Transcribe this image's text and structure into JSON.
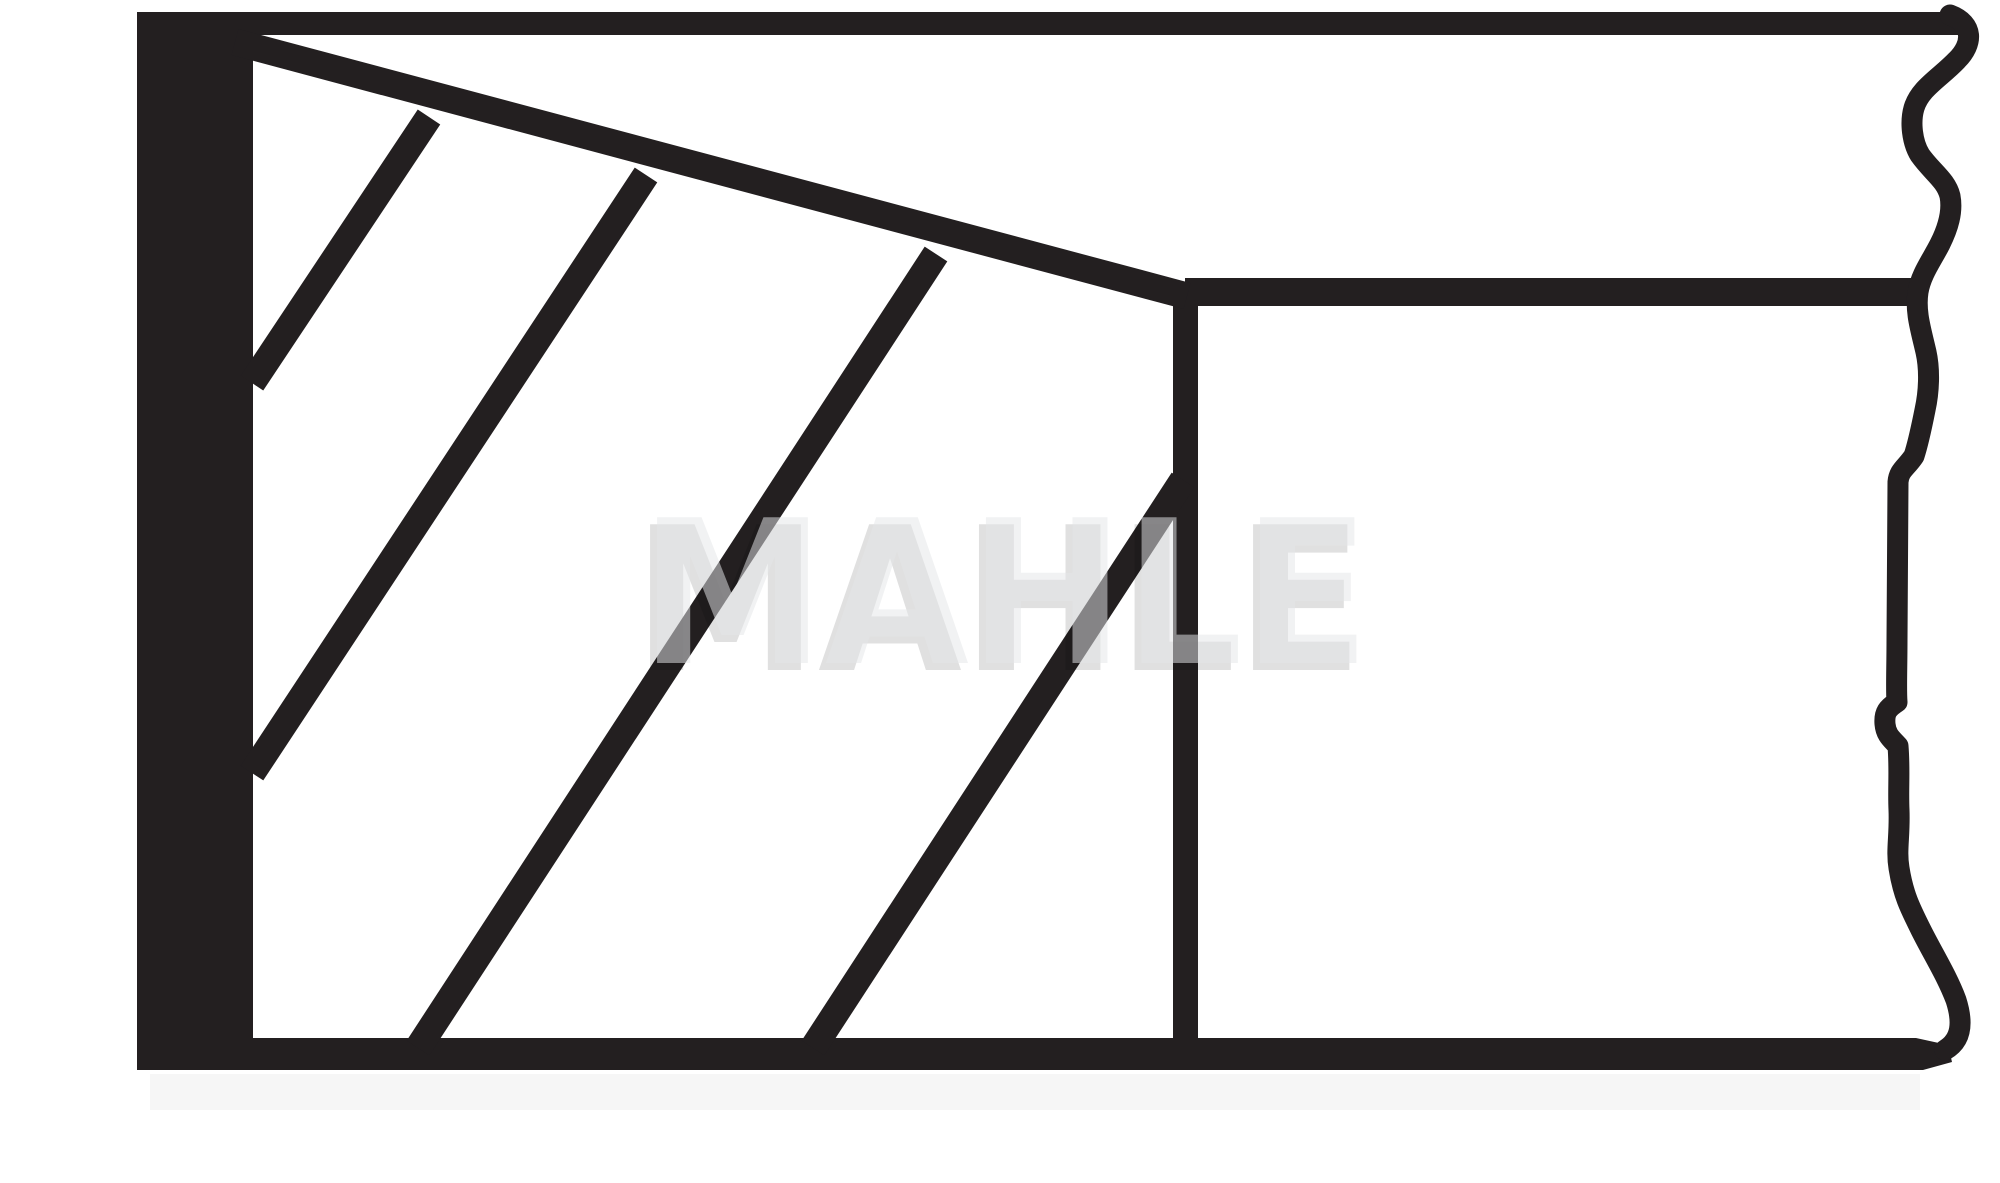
{
  "drawing": {
    "description": "Black-and-white technical line drawing: cross-section of a tapered piston ring (hatched section at left, broken-out side view at right)",
    "ink_color": "#231f20",
    "background_color": "#ffffff",
    "watermark": {
      "text": "MAHLE",
      "face_color": "rgba(228,230,232,0.52)",
      "shadow_color": "rgba(0,0,0,0.12)"
    },
    "shapes": {
      "underlay": {
        "name": "scan-shadow-strip",
        "x": 150,
        "y": 1074,
        "w": 1770,
        "h": 36,
        "fill": "#f6f6f6"
      },
      "rects": [
        {
          "name": "top-flank-line",
          "x": 137,
          "y": 12,
          "w": 1821,
          "h": 23
        },
        {
          "name": "left-face-bar",
          "x": 137,
          "y": 12,
          "w": 116,
          "h": 1058
        },
        {
          "name": "groove-top-line",
          "x": 1185,
          "y": 278,
          "w": 733,
          "h": 28
        },
        {
          "name": "ring-divider-line",
          "x": 1173,
          "y": 283,
          "w": 25,
          "h": 759
        }
      ],
      "polygons": [
        {
          "name": "bottom-flank-line",
          "points": "137,1038 1916,1038 1948,1045 1952,1062 1923,1070 137,1070"
        }
      ],
      "lines": [
        {
          "name": "taper-face-line",
          "x1": 235,
          "y1": 42,
          "x2": 1187,
          "y2": 296,
          "w": 27
        },
        {
          "name": "hatch-line-1",
          "x1": 252,
          "y1": 383,
          "x2": 429,
          "y2": 117,
          "w": 27
        },
        {
          "name": "hatch-line-2",
          "x1": 252,
          "y1": 773,
          "x2": 646,
          "y2": 175,
          "w": 27
        },
        {
          "name": "hatch-line-3",
          "x1": 418,
          "y1": 1048,
          "x2": 936,
          "y2": 254,
          "w": 27
        },
        {
          "name": "hatch-line-4",
          "x1": 813,
          "y1": 1048,
          "x2": 1183,
          "y2": 480,
          "w": 27
        }
      ],
      "paths": [
        {
          "name": "break-line-right",
          "w": 21,
          "d": "M 1950,15 C 1974,24 1973,44 1957,60 C 1940,78 1920,88 1914,108 C 1910,122 1912,142 1920,155 C 1932,172 1946,180 1950,196 C 1953,212 1948,228 1940,244 C 1932,260 1921,274 1918,292 C 1915,312 1921,330 1926,352 C 1930,370 1929,392 1925,410 C 1921,430 1918,444 1914,456 C 1906,468 1899,470 1898,482 L 1897,640 C 1897,668 1896,690 1897,702 C 1888,708 1884,712 1885,724 C 1886,736 1893,740 1898,746 C 1900,770 1898,788 1899,810 C 1900,836 1896,850 1899,868 C 1903,894 1910,908 1921,930 C 1933,954 1947,976 1956,1000 C 1963,1022 1962,1040 1945,1050"
        }
      ]
    }
  }
}
